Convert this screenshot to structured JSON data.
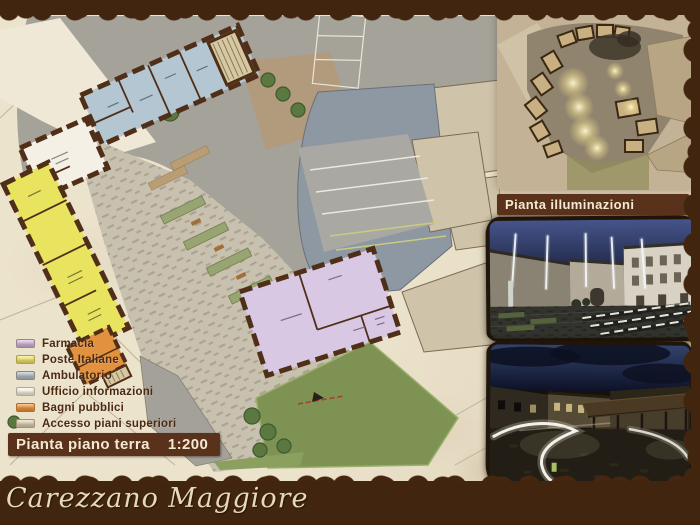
{
  "ground_floor_panel": {
    "title": "Pianta piano terra",
    "scale": "1:200",
    "legend": [
      {
        "label": "Farmacia",
        "color": "#c8b4da"
      },
      {
        "label": "Poste Italiane",
        "color": "#e8e46a"
      },
      {
        "label": "Ambulatorio",
        "color": "#a8bac6"
      },
      {
        "label": "Ufficio informazioni",
        "color": "#f2f0e8"
      },
      {
        "label": "Bagni pubblici",
        "color": "#e79038"
      },
      {
        "label": "Accesso piani superiori",
        "color": "#d8cdb2"
      }
    ]
  },
  "illumination_panel": {
    "title": "Pianta illuminazioni"
  },
  "footer": {
    "project_title": "Carezzano Maggiore"
  },
  "colors": {
    "frame_brown": "#42250f",
    "band_brown": "#5a321b",
    "paper_cream": "#ece3cd",
    "footer_text": "#e6d9ba"
  }
}
